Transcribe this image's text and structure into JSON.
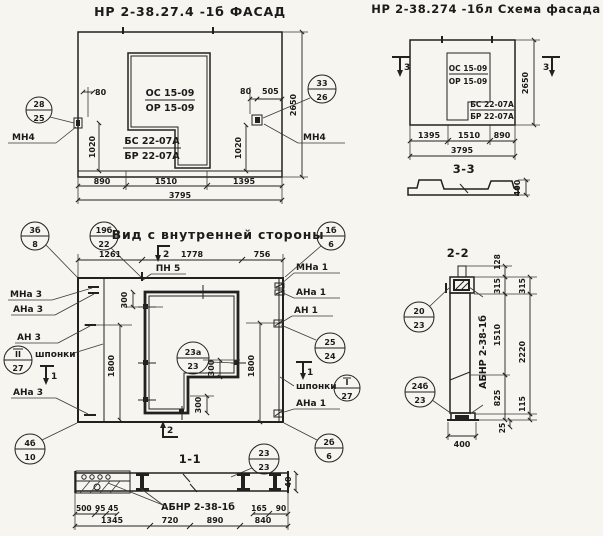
{
  "facade": {
    "title": "НР 2-38.27.4 -1б ФАСАД",
    "win1": "ОС 15-09",
    "win2": "ОР 15-09",
    "sill1": "БС 22-07А",
    "sill2": "БР 22-07А",
    "mn_left": "МН4",
    "mn_right": "МН4",
    "co_left_t": "28",
    "co_left_b": "25",
    "co_right_t": "33",
    "co_right_b": "26",
    "d80l": "80",
    "d1020l": "1020",
    "d80r": "80",
    "d505": "505",
    "d1020r": "1020",
    "d2650": "2650",
    "d890": "890",
    "d1510": "1510",
    "d1395": "1395",
    "d3795": "3795"
  },
  "schema": {
    "title": "НР 2-38.274 -1бл Схема фасада",
    "win1": "ОС 15-09",
    "win2": "ОР 15-09",
    "sill1": "БС 22-07А",
    "sill2": "БР 22-07А",
    "sec": "3",
    "d2650": "2650",
    "d1395": "1395",
    "d1510": "1510",
    "d890": "890",
    "d3795": "3795",
    "sec33": "3-3",
    "d400": "400"
  },
  "inner": {
    "title": "Вид с внутренней стороны",
    "d1261": "1261",
    "d1778": "1778",
    "d756": "756",
    "pn": "ПН 5",
    "sec2": "2",
    "sec1": "1",
    "d300": "300",
    "d1800": "1800",
    "mna3": "МНа 3",
    "ana3": "АНа 3",
    "an3": "АН 3",
    "shponki": "шпонки",
    "mna1": "МНа 1",
    "ana1": "АНа 1",
    "an1": "АН 1",
    "co": {
      "c1t": "3б",
      "c1b": "8",
      "c2t": "19б",
      "c2b": "22",
      "c3t": "1б",
      "c3b": "6",
      "c4t": "25",
      "c4b": "24",
      "c5t": "23а",
      "c5b": "23",
      "c6t": "II",
      "c6b": "27",
      "c7t": "I",
      "c7b": "27",
      "c8t": "4б",
      "c8b": "10",
      "c9t": "2б",
      "c9b": "6"
    }
  },
  "s11": {
    "t": "1-1",
    "label": "АБНР 2-38-1б",
    "cot": "23",
    "cob": "23",
    "d500": "500",
    "d95": "95",
    "d45": "45",
    "d165": "165",
    "d90": "90",
    "d1345": "1345",
    "d720": "720",
    "d890": "890",
    "d840": "840",
    "d40": "40"
  },
  "s22": {
    "t": "2-2",
    "label": "АБНР 2-38-1б",
    "co1t": "20",
    "co1b": "23",
    "co2t": "24б",
    "co2b": "23",
    "d128": "128",
    "d315": "315",
    "d1510": "1510",
    "d2220": "2220",
    "d825": "825",
    "d115": "115",
    "d25": "25",
    "d400": "400"
  }
}
